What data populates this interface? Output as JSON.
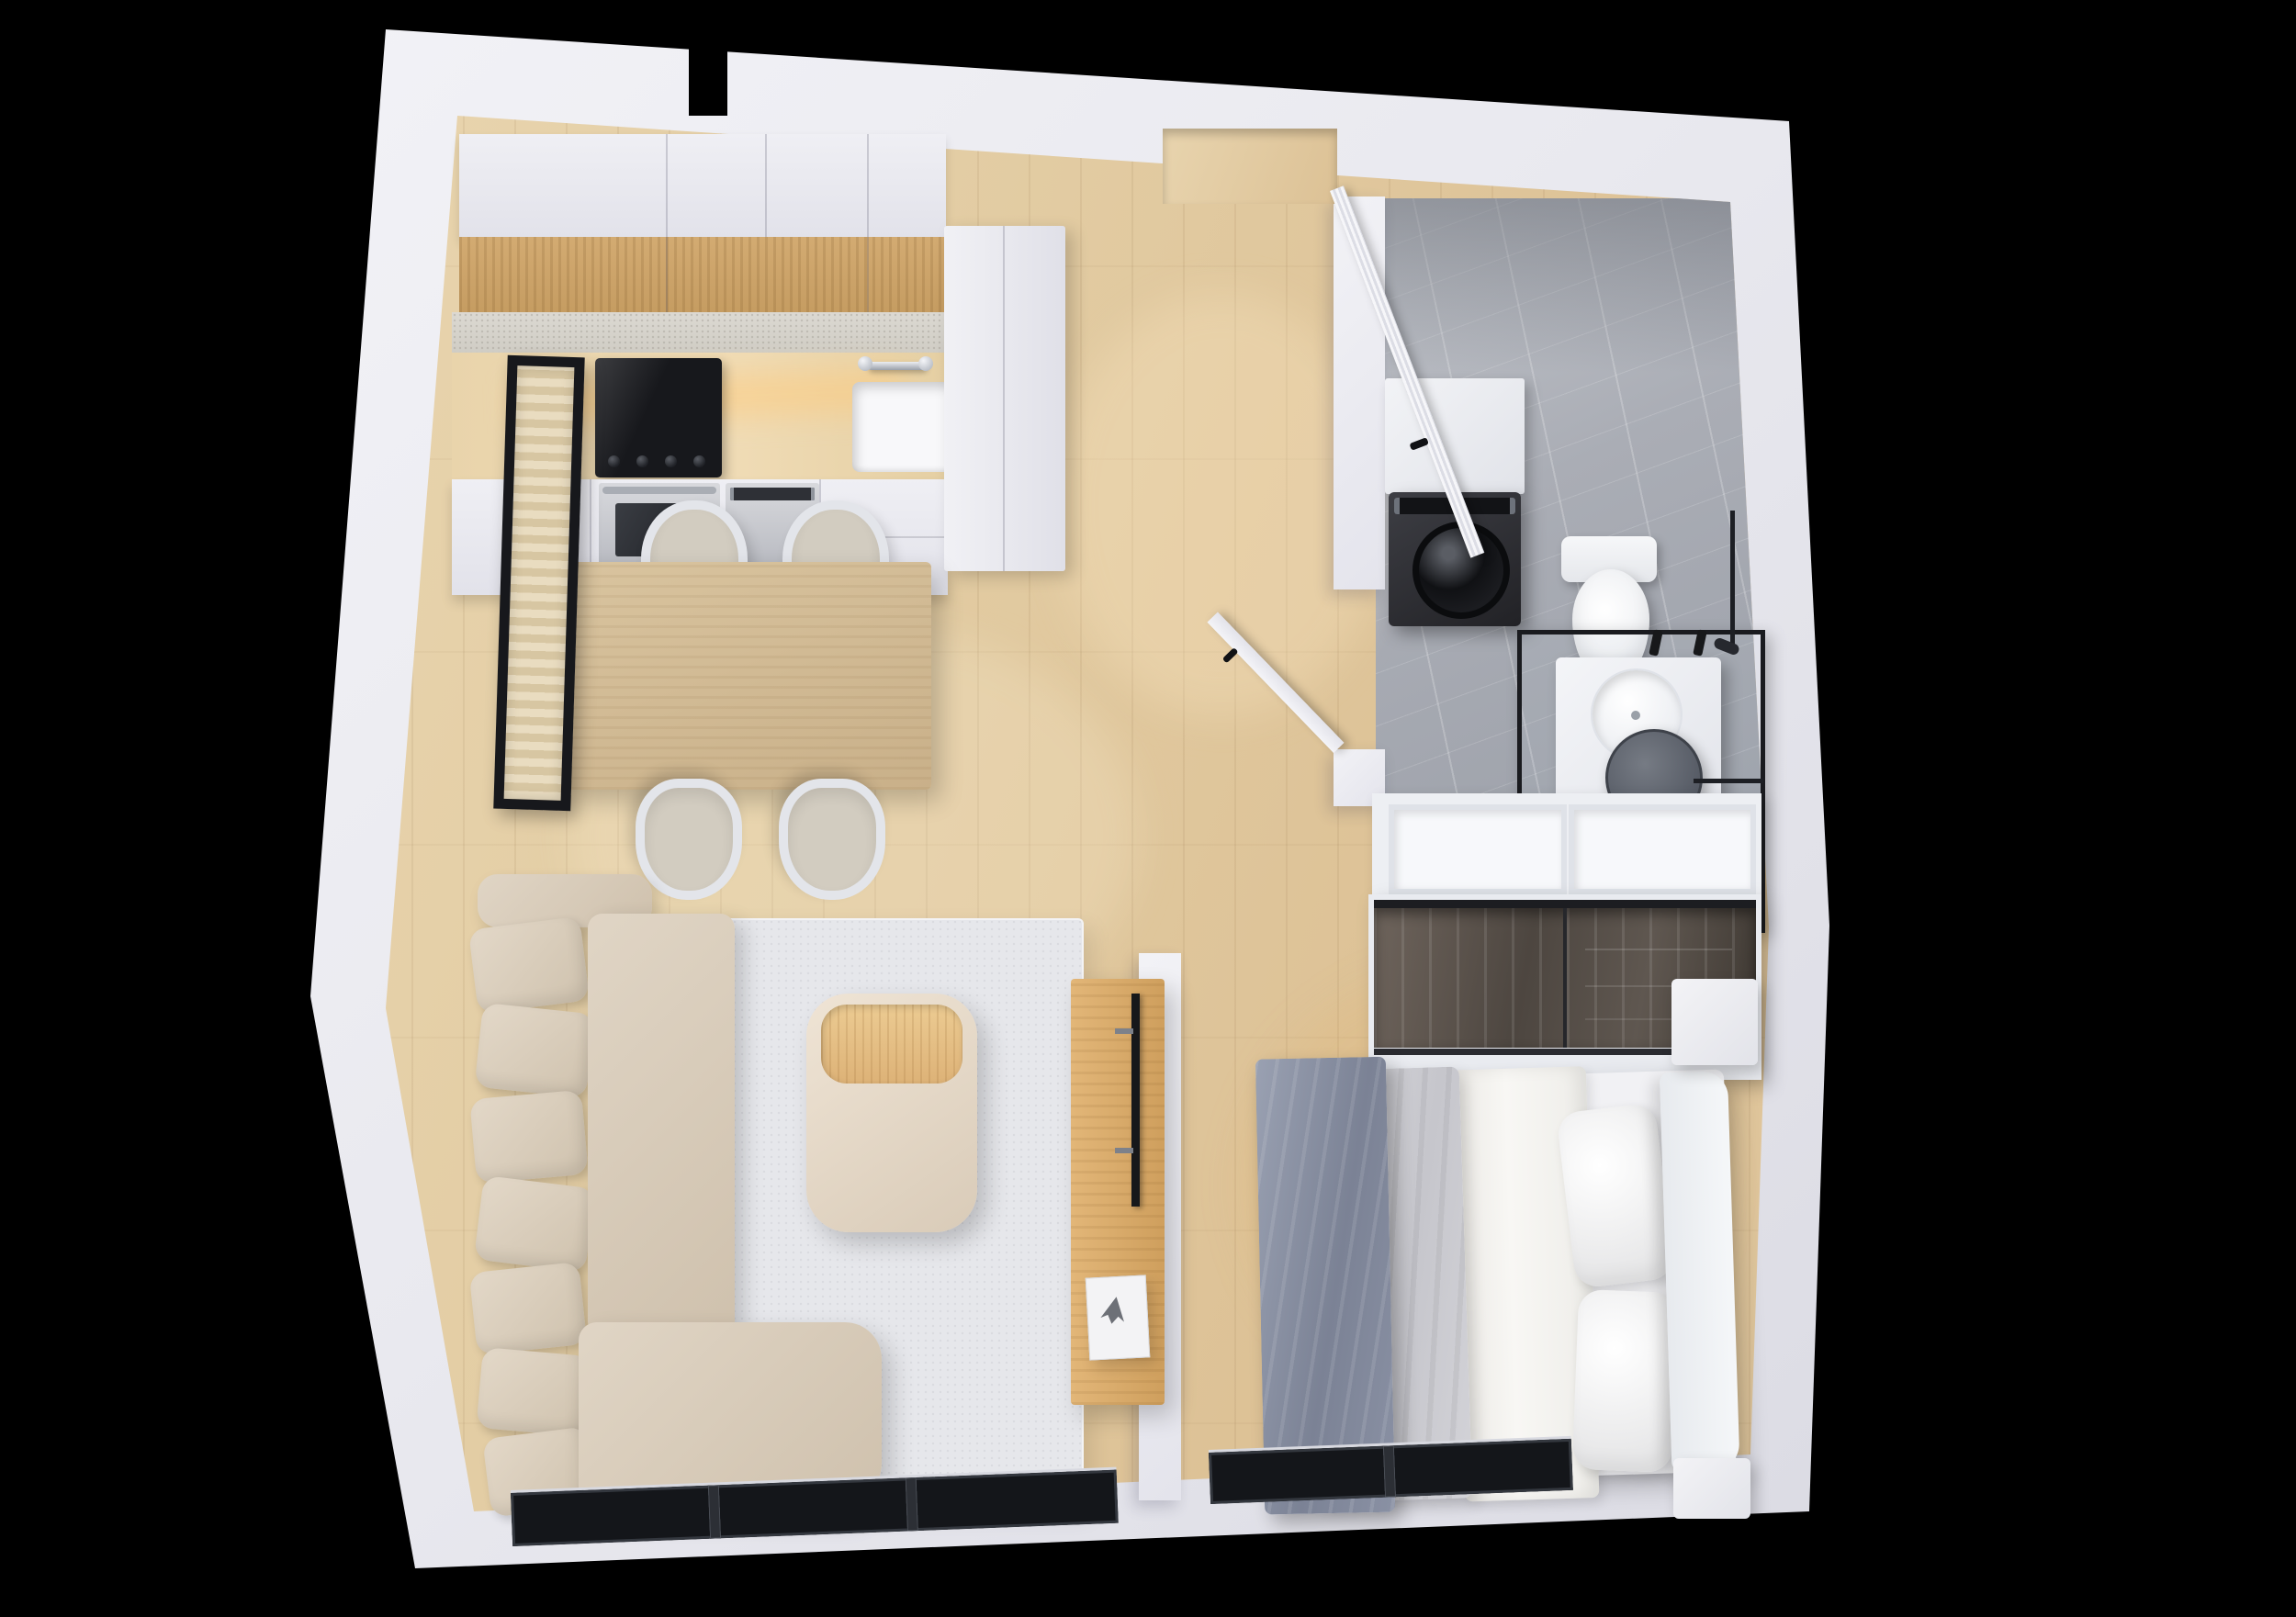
{
  "scene": {
    "title": "Apartment 3D floor plan",
    "style": "top-down dollhouse render on black background",
    "background": "#000000"
  },
  "palette": {
    "wall": "#ebebf1",
    "wall_shade": "#d7d7e0",
    "wood_floor": "#e0c79f",
    "marble_floor": "#aaadb5",
    "rug": "#e6e7eb",
    "sofa_beige": "#d8cbba",
    "bed_throw_gray": "#8b92a4",
    "bed_duvet_gray": "#d2d2d7",
    "wood_furniture": "#d2ab74",
    "appliance_dark": "#232428",
    "window_frame": "#14161a",
    "smoked_glass": "#4d4640"
  },
  "rooms": [
    {
      "id": "living",
      "name": "Living / dining / kitchen",
      "floor": "light oak plank",
      "furniture": [
        "kitchen upper cabinets",
        "wooden cabinet band",
        "stone backsplash ledge",
        "worktop with LED glow",
        "induction cooktop with 4 knobs",
        "built-in oven",
        "dishwasher",
        "white base cabinets",
        "sink with chrome faucet",
        "tall hall cabinet",
        "dining table",
        "four dining chairs",
        "framed wall art",
        "corner sofa with seven cushions",
        "area rug",
        "ottoman coffee table with wooden tray",
        "wooden TV sideboard",
        "wall-mounted TV",
        "book stack with figurine",
        "three-pane window"
      ]
    },
    {
      "id": "hallway",
      "name": "Entrance hall",
      "floor": "light oak plank",
      "furniture": [
        "fluted entry door, open, black handle",
        "bathroom door, open, black handle"
      ]
    },
    {
      "id": "bathroom",
      "name": "Bathroom",
      "floor": "gray marble",
      "furniture": [
        "washing machine with round door",
        "white counter above washer",
        "wall-hung toilet",
        "black framed shower / vanity screen",
        "white vanity unit",
        "round countertop basin",
        "round dark mirror",
        "black towel bar",
        "black taps",
        "shower rail"
      ]
    },
    {
      "id": "bedroom",
      "name": "Bedroom",
      "floor": "light oak plank",
      "furniture": [
        "double bed",
        "white headboard",
        "two white pillows",
        "white sheet",
        "light gray duvet",
        "graphite throw blanket",
        "two white nightstands",
        "smoked-glass sliding wardrobe",
        "open white shelf unit",
        "two-pane window"
      ]
    }
  ]
}
